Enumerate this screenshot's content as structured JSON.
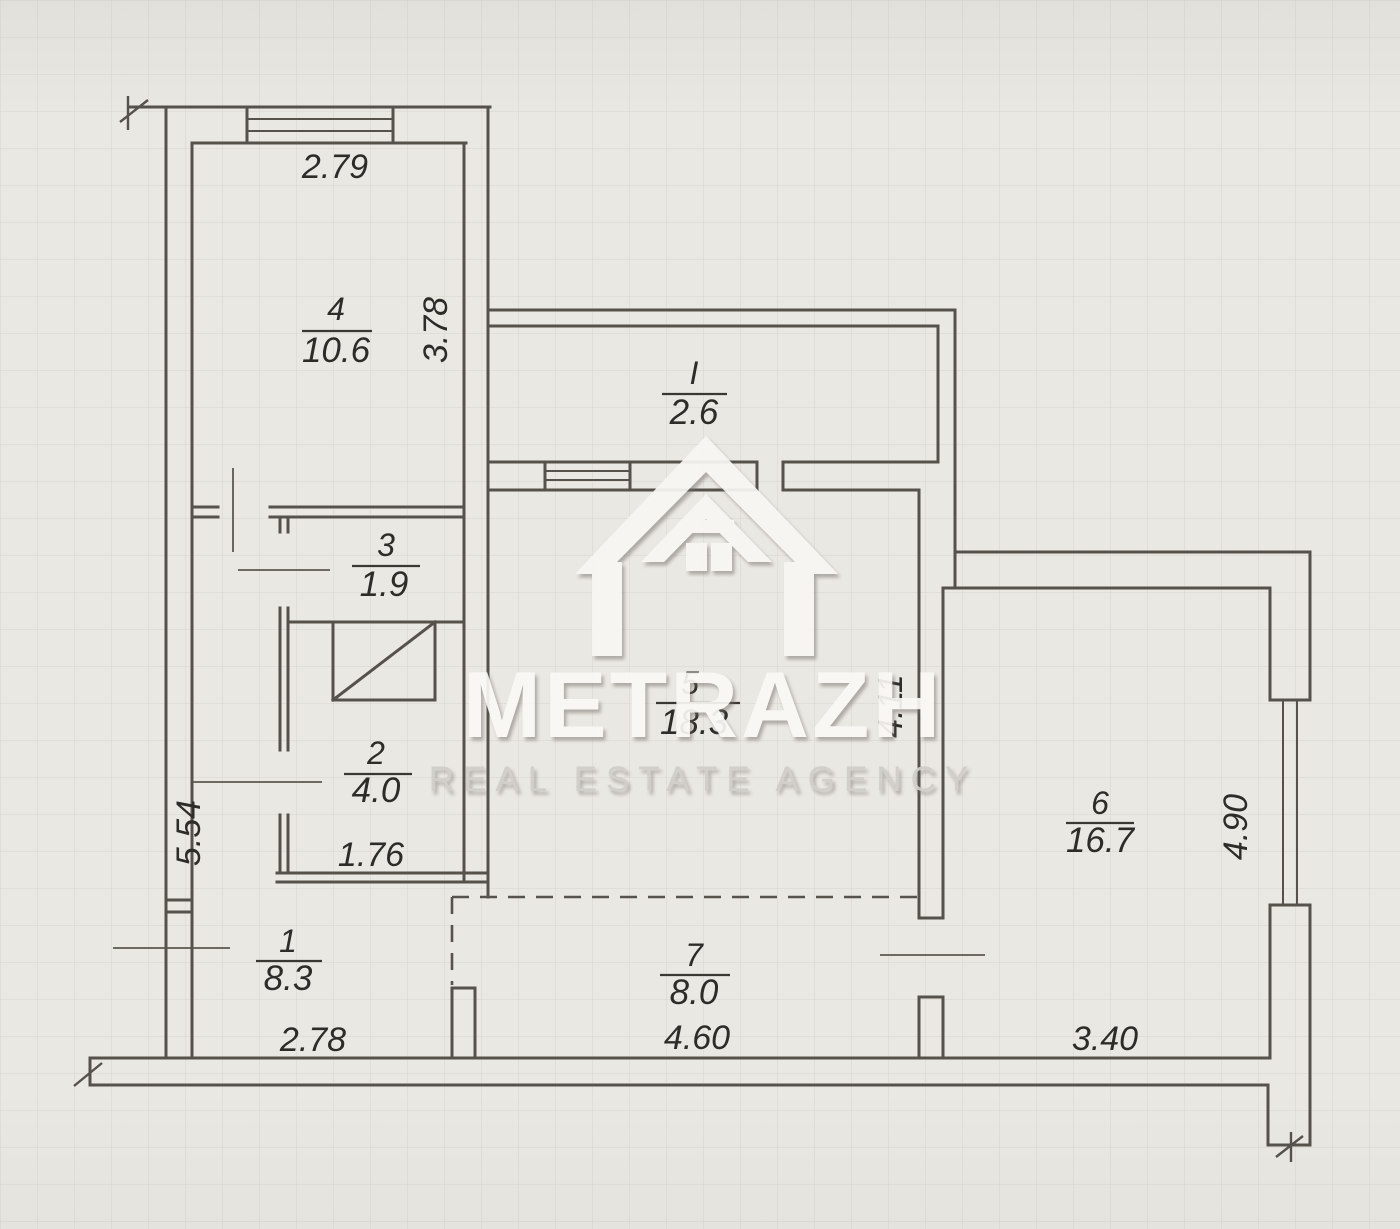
{
  "watermark": {
    "brand": "METRAZH",
    "tagline": "REAL ESTATE AGENCY",
    "logo": "house-logo"
  },
  "rooms": [
    {
      "number": "4",
      "area": "10.6"
    },
    {
      "number": "I",
      "area": "2.6"
    },
    {
      "number": "3",
      "area": "1.9"
    },
    {
      "number": "2",
      "area": "4.0"
    },
    {
      "number": "5",
      "area": "18.3"
    },
    {
      "number": "6",
      "area": "16.7"
    },
    {
      "number": "1",
      "area": "8.3"
    },
    {
      "number": "7",
      "area": "8.0"
    }
  ],
  "dimensions": {
    "room4_width": "2.79",
    "room4_height": "3.78",
    "hall_height": "5.54",
    "room2_width": "1.76",
    "room5_height": "4.11",
    "room6_height": "4.90",
    "bottom_left_width": "2.78",
    "bottom_center_width": "4.60",
    "bottom_right_width": "3.40"
  },
  "colors": {
    "paper": "#eae8e2",
    "wall_line": "#54524b",
    "label_text": "#2e2c28",
    "watermark_white": "#f8f7f4"
  }
}
